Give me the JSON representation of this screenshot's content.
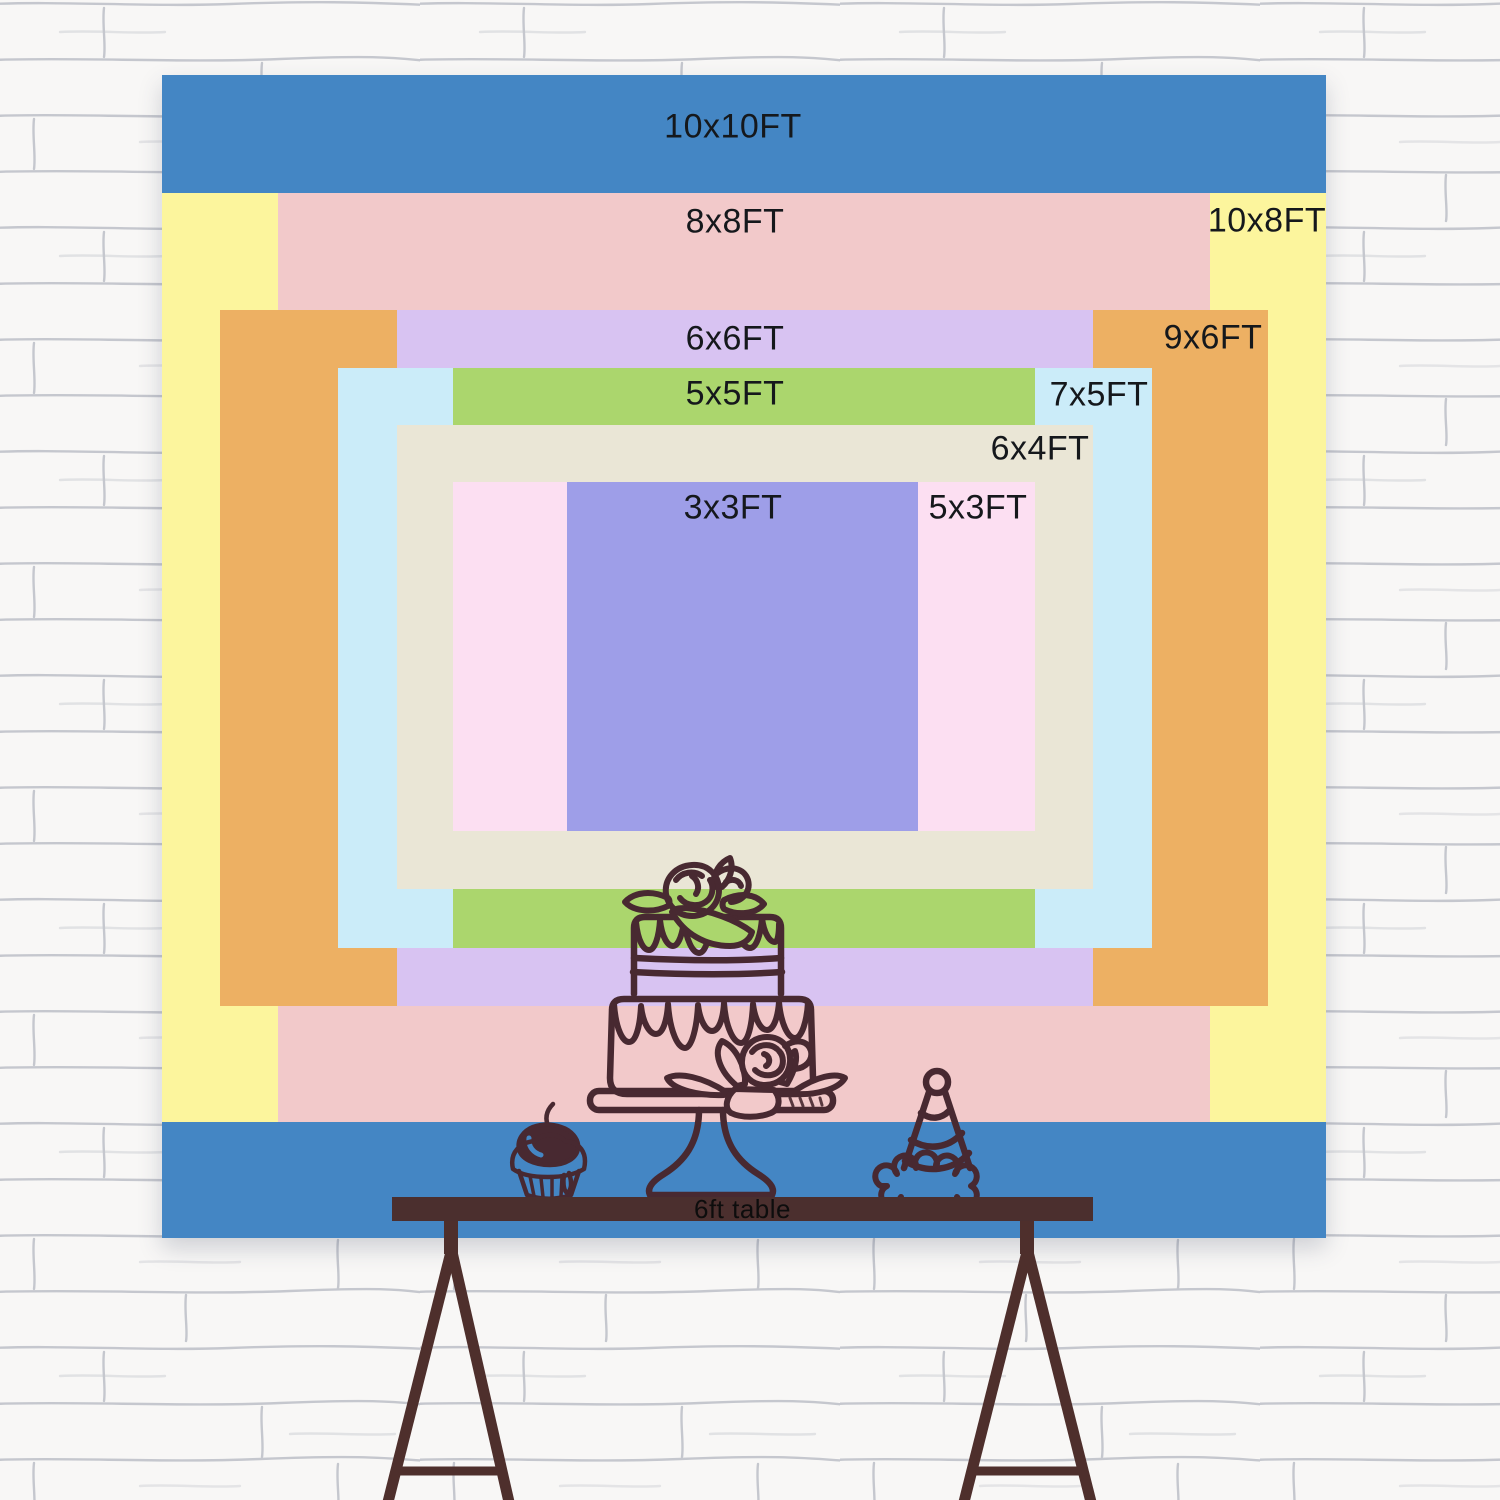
{
  "backdrop": {
    "description": "nested backdrop size comparison",
    "sizes": [
      {
        "name": "10x10FT",
        "color": "#4486c4"
      },
      {
        "name": "10x8FT",
        "color": "#fcf59d"
      },
      {
        "name": "8x8FT",
        "color": "#f2c9ca"
      },
      {
        "name": "9x6FT",
        "color": "#edb063"
      },
      {
        "name": "6x6FT",
        "color": "#d8c3f2"
      },
      {
        "name": "7x5FT",
        "color": "#cbecf9"
      },
      {
        "name": "5x5FT",
        "color": "#abd66d"
      },
      {
        "name": "6x4FT",
        "color": "#eae6d6"
      },
      {
        "name": "5x3FT",
        "color": "#fcdff2"
      },
      {
        "name": "3x3FT",
        "color": "#9e9ee8"
      }
    ]
  },
  "table": {
    "label": "6ft table",
    "top_color": "#4b2f2e",
    "leg_color": "#4e2f2c"
  },
  "artwork": {
    "line_color": "#482931"
  },
  "wall": {
    "base_color": "#f8f7f6",
    "mortar_color": "#9aa0ac"
  }
}
